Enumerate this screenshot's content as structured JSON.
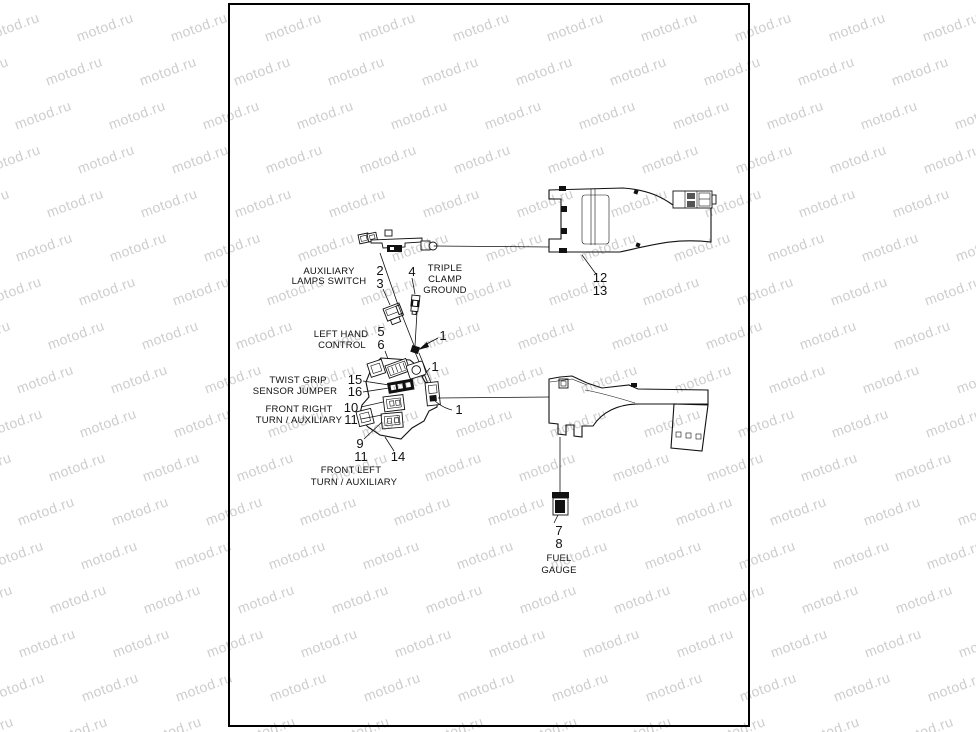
{
  "watermark": {
    "text": "motod.ru",
    "color": "#cdcdcd"
  },
  "page": {
    "labels": {
      "auxiliary_lamps_switch": {
        "line1": "AUXILIARY",
        "line2": "LAMPS SWITCH"
      },
      "triple_clamp_ground": {
        "line1": "TRIPLE",
        "line2": "CLAMP",
        "line3": "GROUND"
      },
      "left_hand_control": {
        "line1": "LEFT HAND",
        "line2": "CONTROL"
      },
      "twist_grip_sensor_jumper": {
        "line1": "TWIST GRIP",
        "line2": "SENSOR JUMPER"
      },
      "front_right_turn_auxiliary": {
        "line1": "FRONT RIGHT",
        "line2": "TURN / AUXILIARY"
      },
      "front_left_turn_auxiliary": {
        "line1": "FRONT LEFT",
        "line2": "TURN / AUXILIARY"
      },
      "fuel_gauge": {
        "line1": "FUEL",
        "line2": "GAUGE"
      }
    },
    "part_numbers": {
      "p1": "1",
      "p2": "2",
      "p3": "3",
      "p4": "4",
      "p5": "5",
      "p6": "6",
      "p7": "7",
      "p8": "8",
      "p9": "9",
      "p10": "10",
      "p11": "11",
      "p12": "12",
      "p13": "13",
      "p14": "14",
      "p15": "15",
      "p16": "16"
    }
  }
}
